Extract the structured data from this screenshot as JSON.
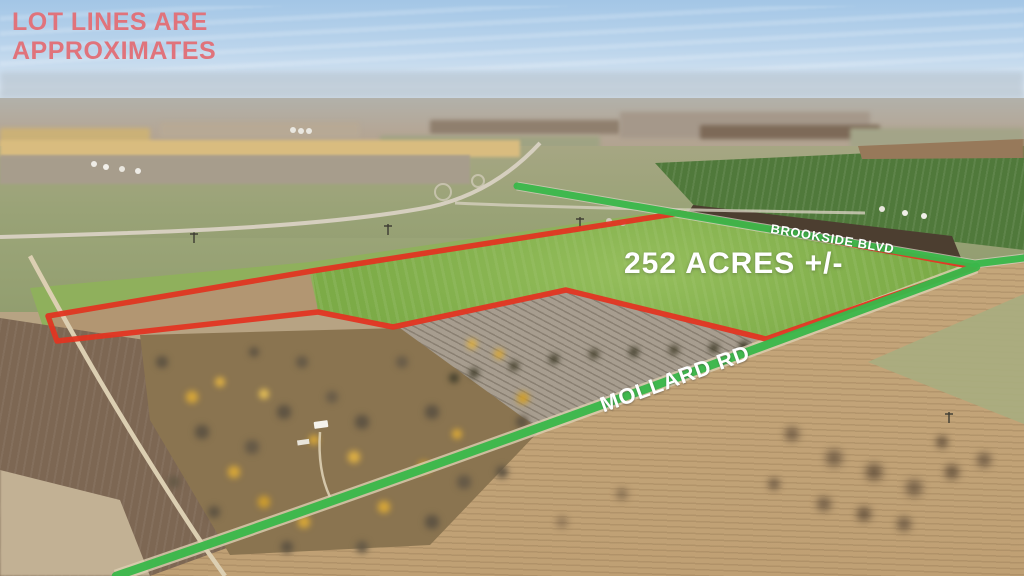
{
  "scene": {
    "type": "aerial-real-estate-photo",
    "description": "Drone aerial view of farmland parcel with lot-line and road overlays"
  },
  "disclaimer": {
    "line1": "LOT LINES ARE",
    "line2": "APPROXIMATES"
  },
  "acreage": {
    "label": "252 ACRES +/-"
  },
  "roads": [
    {
      "label": "BROOKSIDE BLVD"
    },
    {
      "label": "MOLLARD RD"
    }
  ],
  "colors": {
    "lot_line": "#e23522",
    "road_highlight": "#3ab74a",
    "disclaimer_text": "#e0737b",
    "label_text": "#ffffff"
  }
}
